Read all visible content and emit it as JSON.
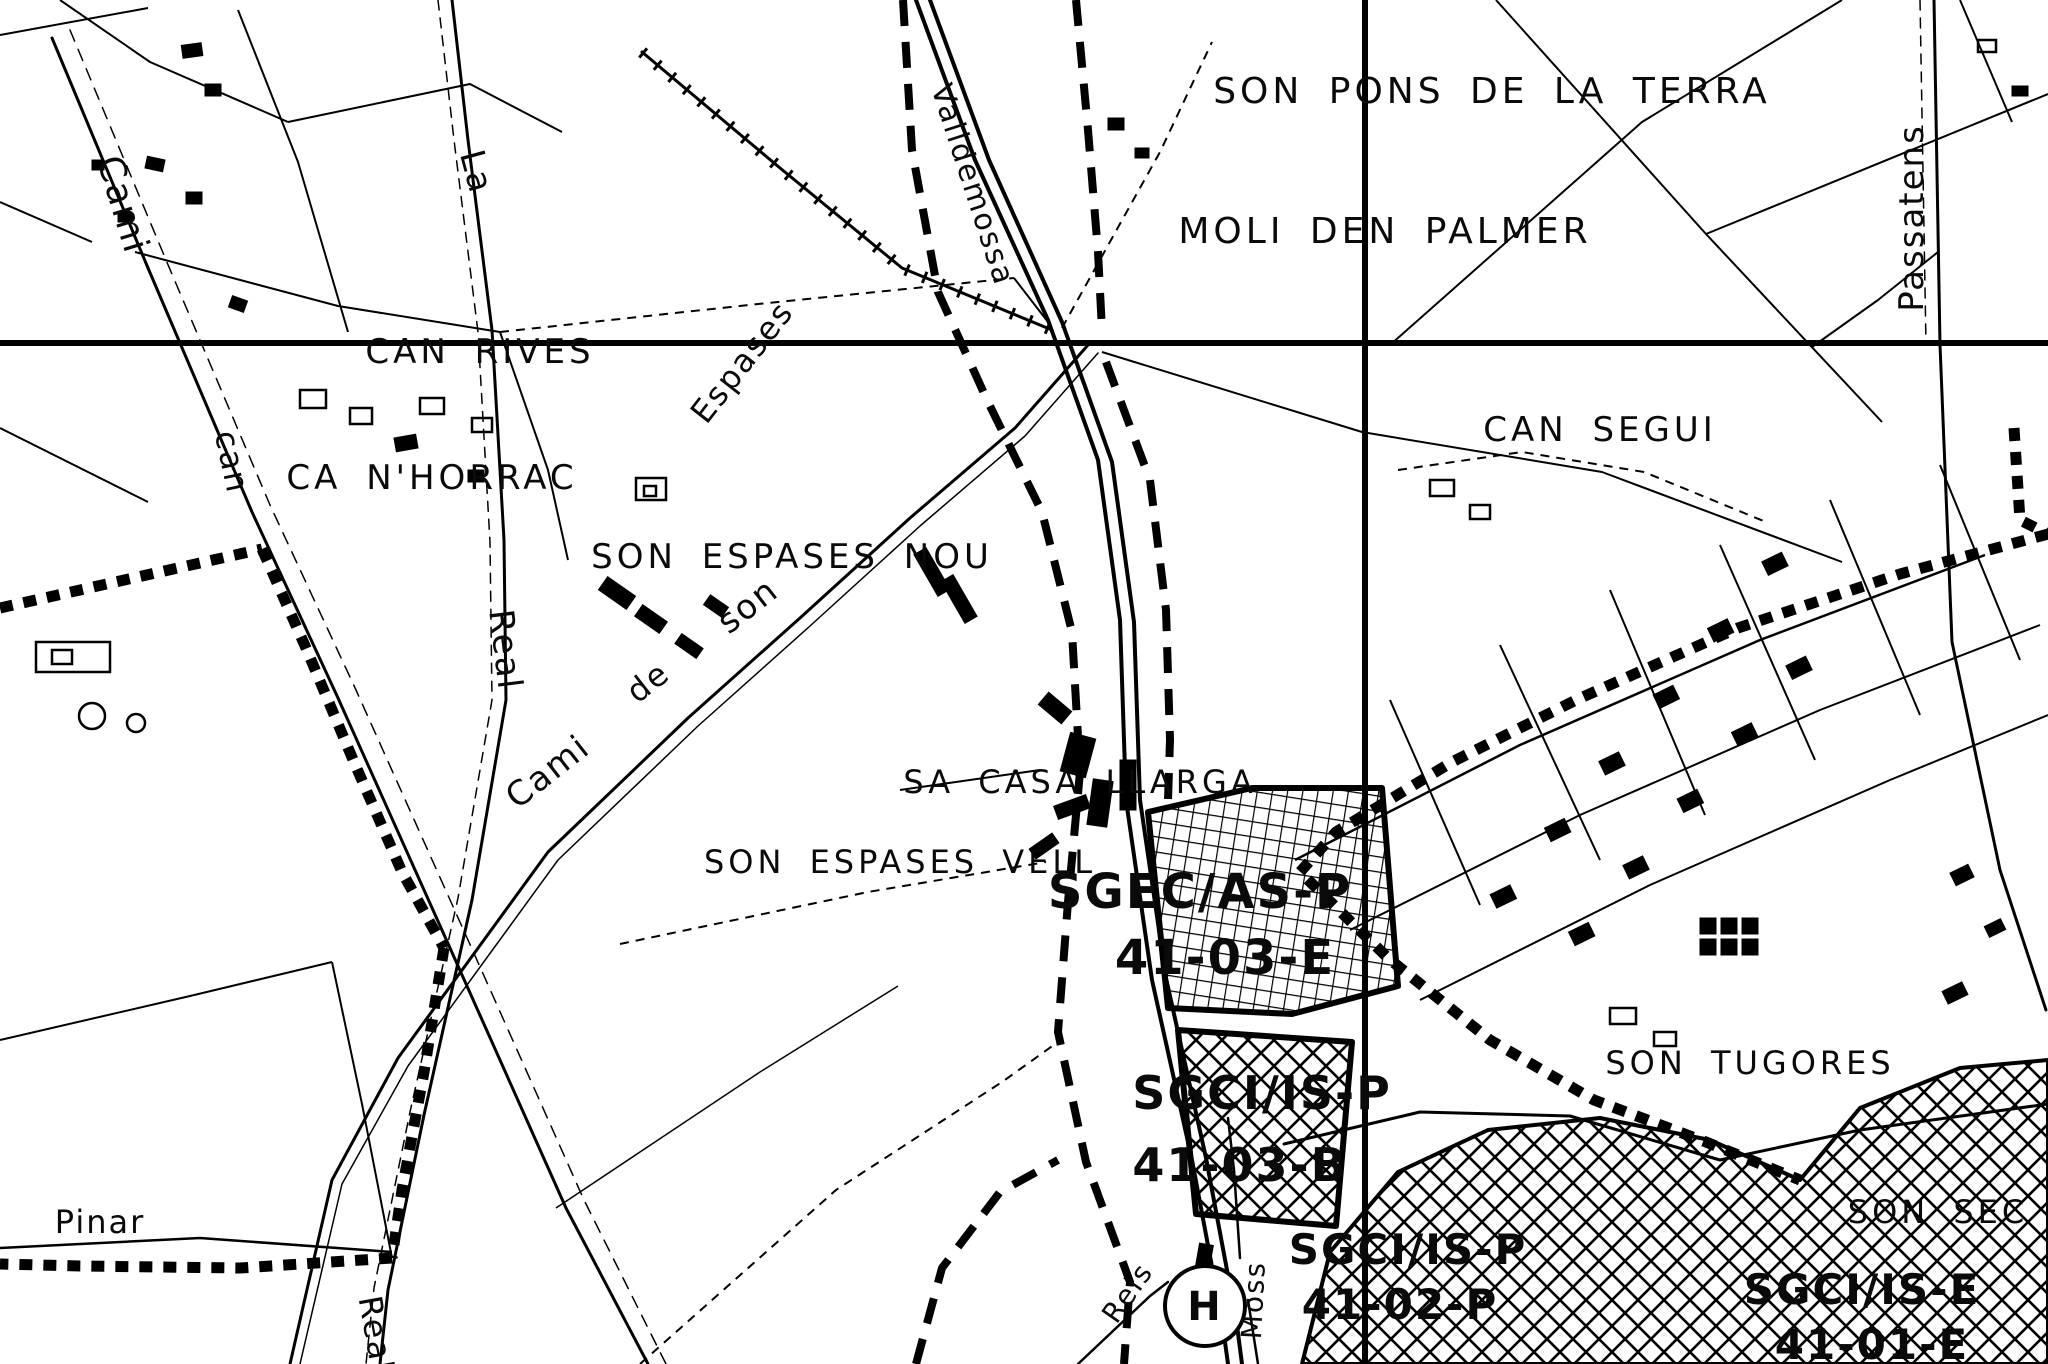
{
  "map": {
    "type": "scanned cadastral / planning map, monochrome",
    "colors": {
      "background": "#ffffff",
      "ink": "#000000"
    },
    "grid": {
      "horizontal_line_y": 343,
      "vertical_line_x": 1365
    },
    "labels": [
      {
        "id": "son-pons-de-la-terra",
        "text": "SON PONS DE LA TERRA",
        "x": 1492,
        "y": 92,
        "rot": 0,
        "size": 36,
        "cls": "caps"
      },
      {
        "id": "moli-den-palmer",
        "text": "MOLI DEN PALMER",
        "x": 1385,
        "y": 232,
        "rot": 0,
        "size": 36,
        "cls": "caps"
      },
      {
        "id": "cami-top-left",
        "text": "Cami",
        "x": 122,
        "y": 205,
        "rot": 73,
        "size": 36,
        "cls": "small-name"
      },
      {
        "id": "la",
        "text": "La",
        "x": 476,
        "y": 172,
        "rot": 75,
        "size": 34,
        "cls": "small-name"
      },
      {
        "id": "can-left",
        "text": "can",
        "x": 232,
        "y": 462,
        "rot": 78,
        "size": 32,
        "cls": "small-name"
      },
      {
        "id": "can-rives",
        "text": "CAN RIVES",
        "x": 480,
        "y": 352,
        "rot": 0,
        "size": 34,
        "cls": "caps"
      },
      {
        "id": "ca-nhorrac",
        "text": "CA N'HORRAC",
        "x": 432,
        "y": 478,
        "rot": 0,
        "size": 34,
        "cls": "caps"
      },
      {
        "id": "son-espases-nou",
        "text": "SON ESPASES NOU",
        "x": 792,
        "y": 557,
        "rot": 0,
        "size": 34,
        "cls": "caps"
      },
      {
        "id": "can-segui",
        "text": "CAN SEGUI",
        "x": 1600,
        "y": 430,
        "rot": 0,
        "size": 34,
        "cls": "caps"
      },
      {
        "id": "passatens",
        "text": "Passatens",
        "x": 1912,
        "y": 218,
        "rot": -90,
        "size": 34,
        "cls": "small-name"
      },
      {
        "id": "valldemossa",
        "text": "Valldemossa",
        "x": 972,
        "y": 185,
        "rot": 72,
        "size": 30,
        "cls": "small-name"
      },
      {
        "id": "real",
        "text": "Real",
        "x": 505,
        "y": 650,
        "rot": 83,
        "size": 34,
        "cls": "small-name"
      },
      {
        "id": "cami-son-espases",
        "text": "Cami",
        "x": 548,
        "y": 772,
        "rot": -38,
        "size": 34,
        "cls": "small-name"
      },
      {
        "id": "de",
        "text": "de",
        "x": 648,
        "y": 682,
        "rot": -38,
        "size": 32,
        "cls": "small-name"
      },
      {
        "id": "son",
        "text": "son",
        "x": 748,
        "y": 606,
        "rot": -38,
        "size": 34,
        "cls": "small-name"
      },
      {
        "id": "espases-rotated",
        "text": "Espases",
        "x": 742,
        "y": 362,
        "rot": -52,
        "size": 32,
        "cls": "small-name"
      },
      {
        "id": "sa-casa-llarga",
        "text": "SA CASA LLARGA",
        "x": 1080,
        "y": 782,
        "rot": 0,
        "size": 32,
        "cls": "caps"
      },
      {
        "id": "son-espases-vell",
        "text": "SON ESPASES VELL",
        "x": 900,
        "y": 862,
        "rot": 0,
        "size": 32,
        "cls": "caps"
      },
      {
        "id": "zone-sgec-as-p",
        "text": "SGEC/AS-P",
        "x": 1200,
        "y": 892,
        "rot": 0,
        "size": 48,
        "cls": "zone"
      },
      {
        "id": "zone-41-03-e",
        "text": "41-03-E",
        "x": 1225,
        "y": 958,
        "rot": 0,
        "size": 48,
        "cls": "zone"
      },
      {
        "id": "zone-sgci-is-p",
        "text": "SGCI/IS-P",
        "x": 1262,
        "y": 1093,
        "rot": 0,
        "size": 46,
        "cls": "zone"
      },
      {
        "id": "zone-41-03-b",
        "text": "41-03-B",
        "x": 1240,
        "y": 1165,
        "rot": 0,
        "size": 46,
        "cls": "zone"
      },
      {
        "id": "son-tugores",
        "text": "SON TUGORES",
        "x": 1750,
        "y": 1063,
        "rot": 0,
        "size": 32,
        "cls": "caps"
      },
      {
        "id": "son-sec",
        "text": "SON SEC",
        "x": 1938,
        "y": 1212,
        "rot": 0,
        "size": 32,
        "cls": "caps"
      },
      {
        "id": "zone-sgci-is-p-2",
        "text": "SGCI/IS-P",
        "x": 1408,
        "y": 1250,
        "rot": 0,
        "size": 42,
        "cls": "zone"
      },
      {
        "id": "zone-41-02-p",
        "text": "41-02-P",
        "x": 1400,
        "y": 1305,
        "rot": 0,
        "size": 42,
        "cls": "zone"
      },
      {
        "id": "zone-sgci-is-e",
        "text": "SGCI/IS-E",
        "x": 1862,
        "y": 1290,
        "rot": 0,
        "size": 42,
        "cls": "zone"
      },
      {
        "id": "zone-41-01-e",
        "text": "41-01-E",
        "x": 1872,
        "y": 1345,
        "rot": 0,
        "size": 42,
        "cls": "zone"
      },
      {
        "id": "pinar",
        "text": "Pinar",
        "x": 100,
        "y": 1222,
        "rot": 0,
        "size": 32,
        "cls": "small-name"
      },
      {
        "id": "reis",
        "text": "Reis",
        "x": 1128,
        "y": 1293,
        "rot": -55,
        "size": 28,
        "cls": "small-name"
      },
      {
        "id": "moss",
        "text": "Moss",
        "x": 1254,
        "y": 1300,
        "rot": -87,
        "size": 28,
        "cls": "small-name"
      },
      {
        "id": "real-bottom",
        "text": "Real",
        "x": 376,
        "y": 1334,
        "rot": 80,
        "size": 32,
        "cls": "small-name"
      },
      {
        "id": "hospital-h",
        "text": "H",
        "x": 1205,
        "y": 1307,
        "rot": 0,
        "size": 40,
        "cls": "zone"
      }
    ]
  }
}
